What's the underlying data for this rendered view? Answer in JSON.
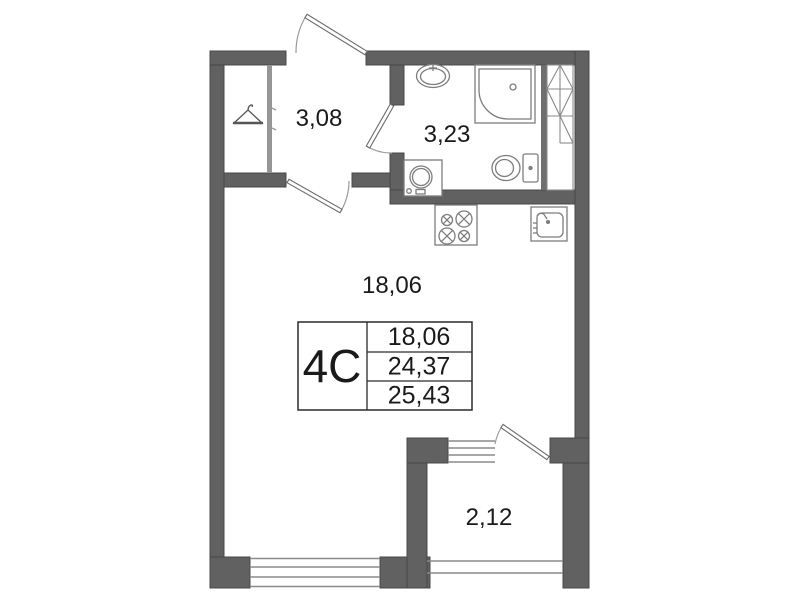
{
  "rooms": {
    "hall": {
      "area": "3,08"
    },
    "bathroom": {
      "area": "3,23"
    },
    "living_room": {
      "area": "18,06"
    },
    "balcony": {
      "area": "2,12"
    }
  },
  "info_table": {
    "unit": "4С",
    "rows": [
      "18,06",
      "24,37",
      "25,43"
    ]
  },
  "fixtures": [
    "hanger",
    "washbasin",
    "shower-cabin",
    "toilet",
    "washing-machine",
    "stove",
    "kitchen-sink",
    "ventilation-shaft"
  ],
  "colors": {
    "wall": "#616161",
    "thin_line": "#8a8a8a",
    "fixture_line": "#7d7d7d",
    "text": "#1a1a1a"
  }
}
